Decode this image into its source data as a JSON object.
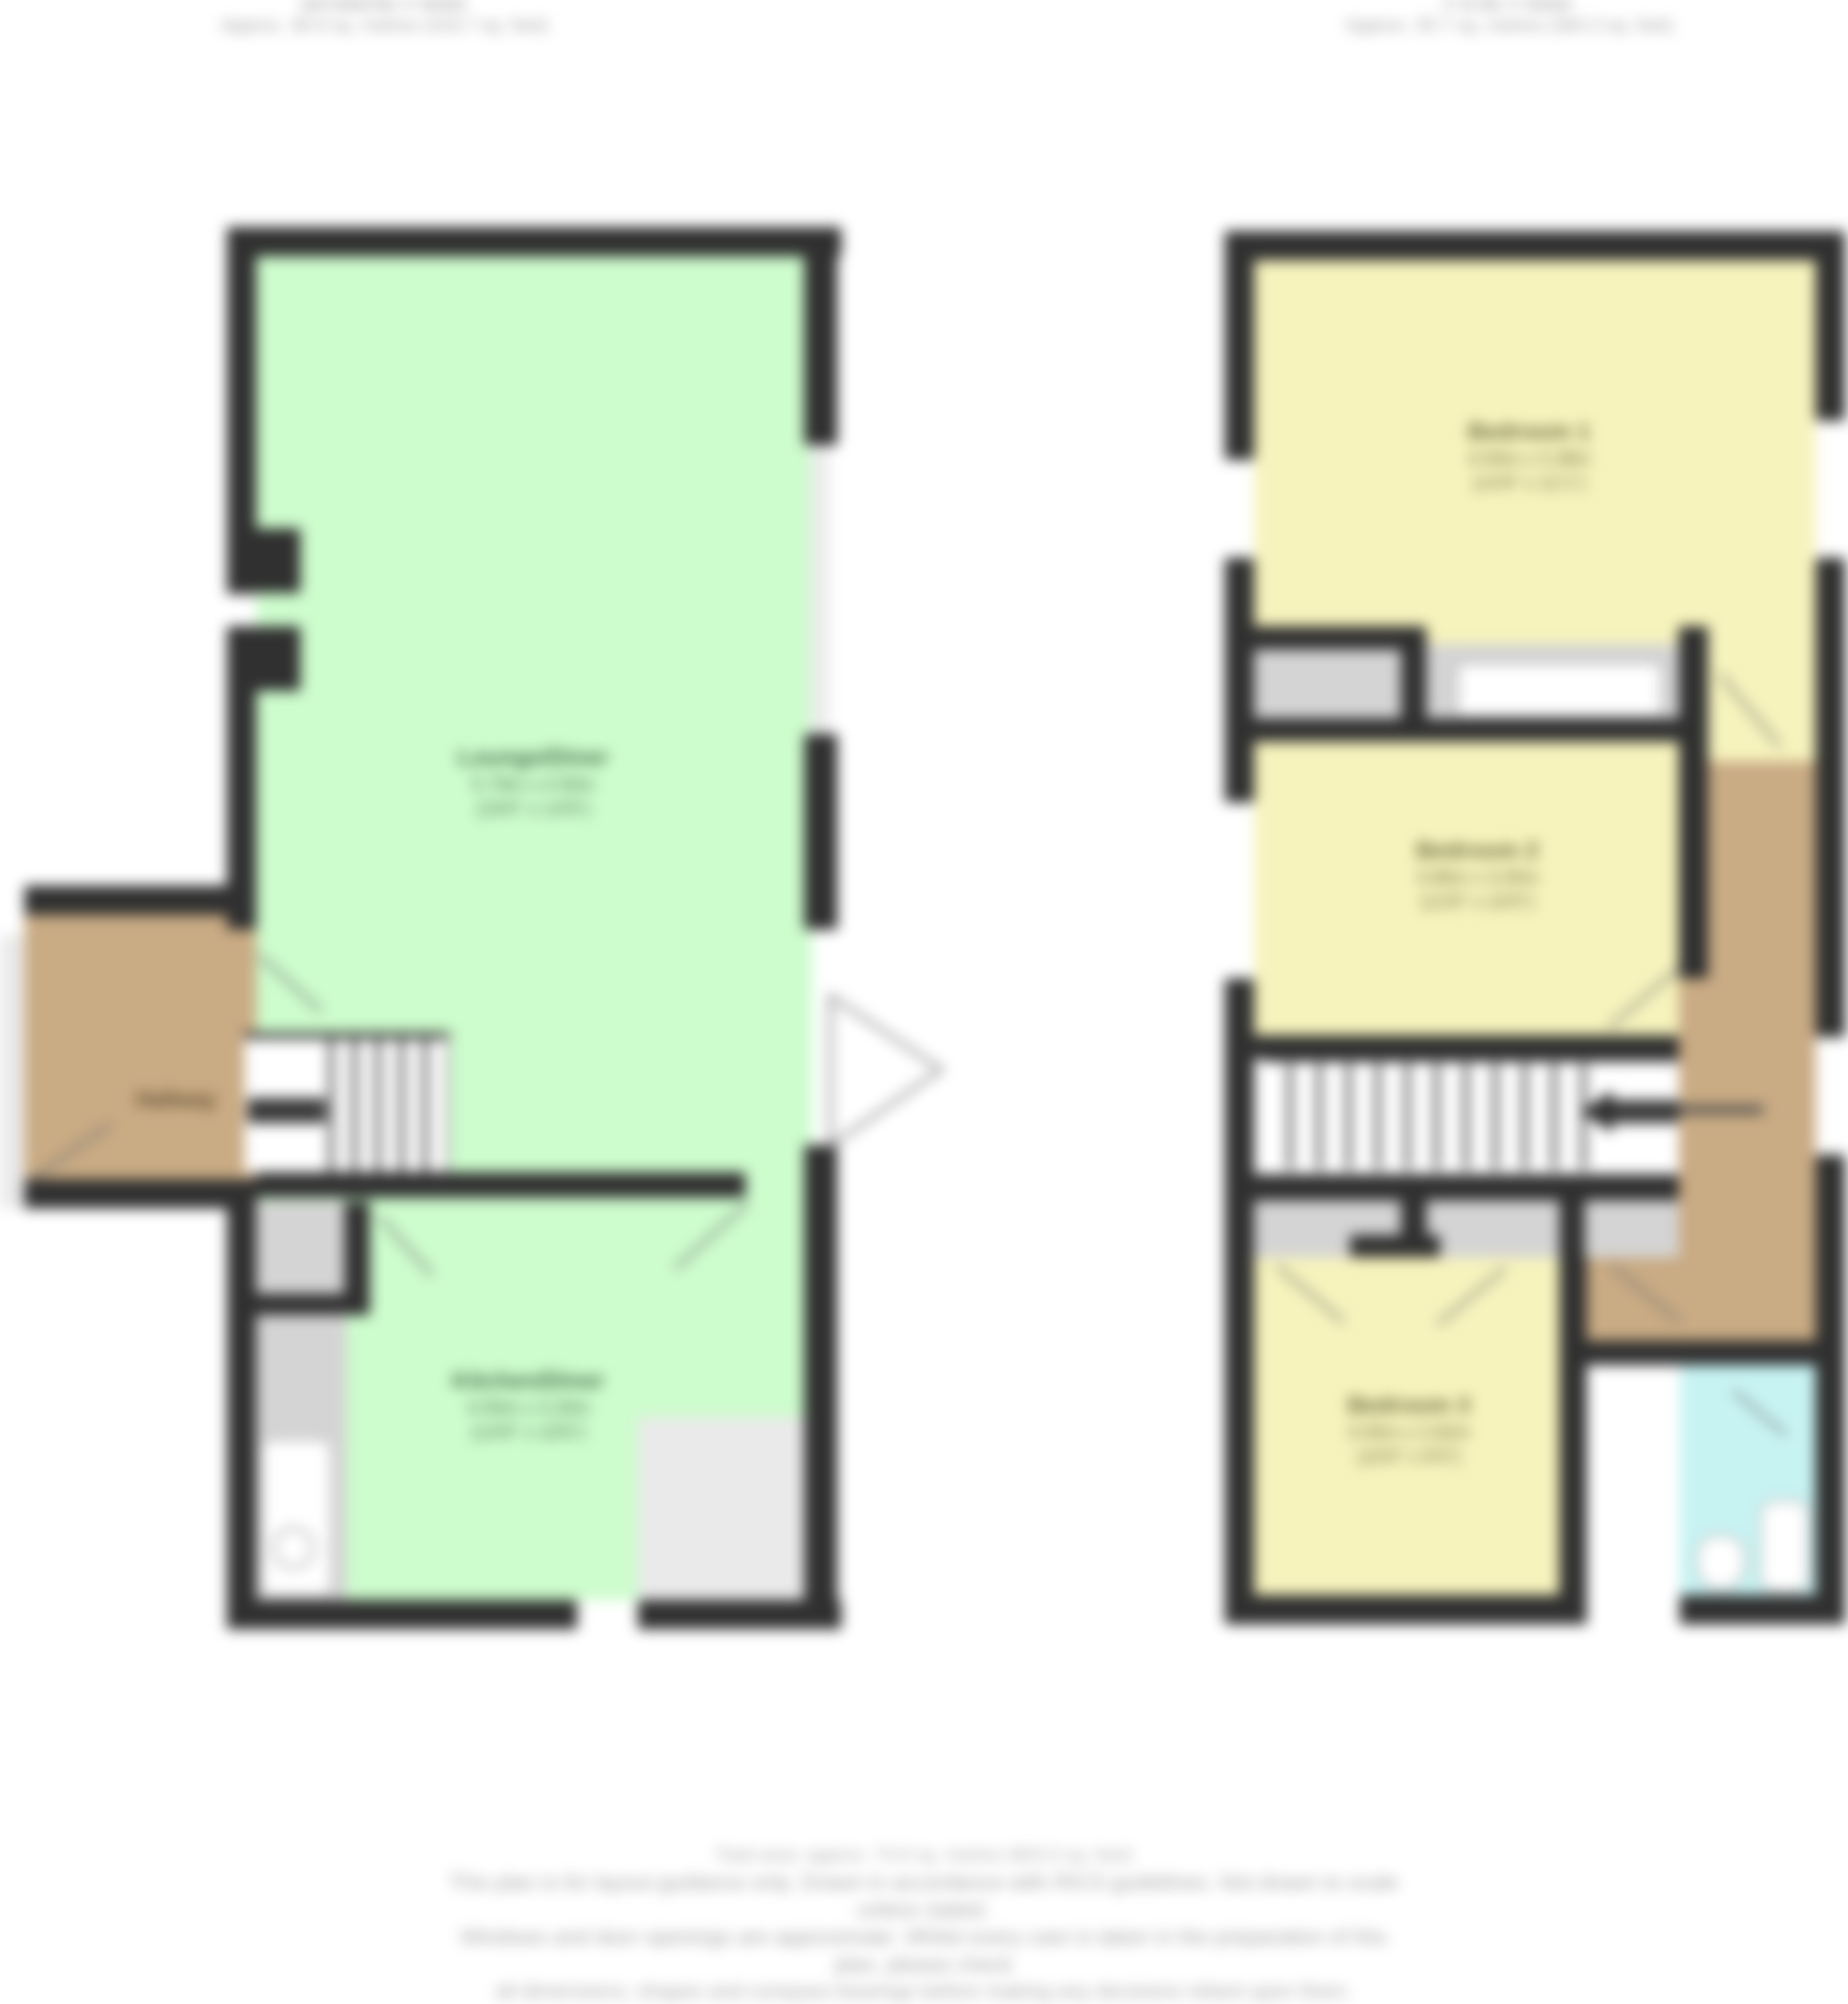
{
  "colors": {
    "wall": "#303030",
    "green": "#cdfccd",
    "yellow": "#f7f3bd",
    "brown": "#c9ab84",
    "cyan": "#c8f3f3",
    "gray": "#d4d4d4",
    "lgray": "#eaeaea"
  },
  "titles": {
    "ground": {
      "line1": "Ground Floor",
      "line2": "Approx. 38.9 sq. metres (418.7 sq. feet)"
    },
    "first": {
      "line1": "First Floor",
      "line2": "Approx. 35.7 sq. metres (384.3 sq. feet)"
    }
  },
  "ground_floor": {
    "living_room": {
      "name": "Lounge/Diner",
      "dims_m": "5.79m x 4.50m",
      "dims_ft": "(19'0\" x 14'9\")"
    },
    "kitchen": {
      "name": "Kitchen/Diner",
      "dims_m": "4.50m x 3.20m",
      "dims_ft": "(14'9\" x 10'6\")"
    },
    "hallway": {
      "name": "Hallway"
    }
  },
  "first_floor": {
    "bedroom1": {
      "name": "Bedroom 1",
      "dims_m": "4.50m x 3.38m",
      "dims_ft": "(14'9\" x 11'1\")"
    },
    "bedroom2": {
      "name": "Bedroom 2",
      "dims_m": "3.86m x 3.05m",
      "dims_ft": "(12'8\" x 10'0\")"
    },
    "bedroom3": {
      "name": "Bedroom 3",
      "dims_m": "3.05m x 2.82m",
      "dims_ft": "(10'0\" x 9'3\")"
    }
  },
  "disclaimer": {
    "line1": "Total area: approx. 74.6 sq. metres (803.0 sq. feet)",
    "line2": "This plan is for layout guidance only. Drawn in accordance with RICS guidelines. Not drawn to scale unless stated.",
    "line3": "Windows and door openings are approximate. Whilst every care is taken in the preparation of this plan, please check",
    "line4": "all dimensions, shapes and compass bearings before making any decisions reliant upon them.",
    "line5": "Plan produced using PlanUp."
  }
}
